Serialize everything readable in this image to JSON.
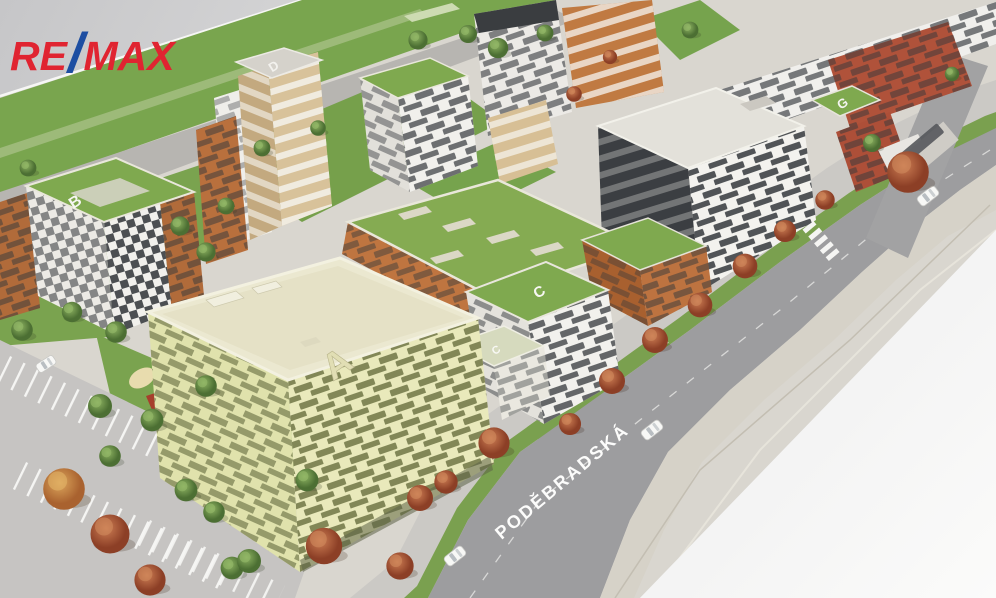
{
  "branding": {
    "logo_re": "RE",
    "logo_slash": "/",
    "logo_max": "MAX"
  },
  "street": {
    "name": "PODĚBRADSKÁ",
    "metro_label": "M"
  },
  "building_labels": {
    "a": "A",
    "b": "B",
    "c": "C",
    "c_lower": "C",
    "d": "D",
    "g": "G"
  },
  "palette": {
    "remax_red": "#E02431",
    "remax_blue": "#1D4EA2",
    "roof_green": "#7FA94F",
    "facade_yellow": "#E9E9BB",
    "facade_white": "#F2F1ED",
    "facade_orange": "#BD7340",
    "facade_brick": "#B0523A",
    "facade_dark": "#3B3E42",
    "road_gray": "#9D9D9F",
    "model_base": "#D9D6CF",
    "autumn_tree": "#B35C3C",
    "green_tree": "#6F9C4E"
  }
}
